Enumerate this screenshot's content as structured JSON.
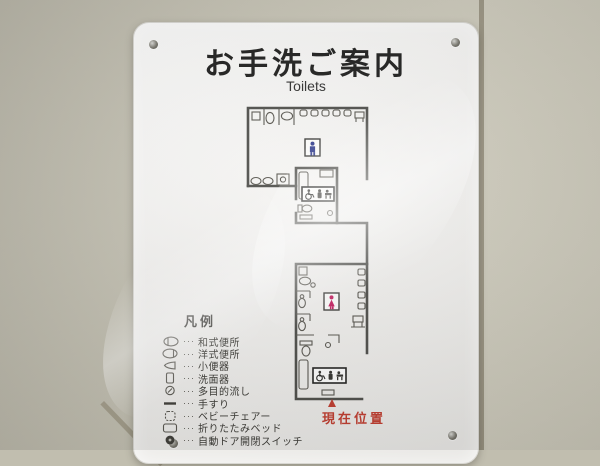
{
  "panel": {
    "title": "お手洗ご案内",
    "subtitle": "Toilets"
  },
  "floorplan": {
    "current_location_label": "現在位置",
    "mens_icon": "male-figure",
    "womens_icon": "female-figure",
    "accessible_icons": [
      "wheelchair",
      "baby-chair",
      "baby-changing"
    ]
  },
  "legend": {
    "heading": "凡例",
    "leader": "···",
    "items": [
      {
        "icon": "squat-toilet",
        "label": "和式便所"
      },
      {
        "icon": "western-toilet",
        "label": "洋式便所"
      },
      {
        "icon": "urinal",
        "label": "小便器"
      },
      {
        "icon": "washbasin",
        "label": "洗面器"
      },
      {
        "icon": "multipurpose-sink",
        "label": "多目的流し"
      },
      {
        "icon": "handrail",
        "label": "手すり"
      },
      {
        "icon": "baby-chair",
        "label": "ベビーチェアー"
      },
      {
        "icon": "folding-bed",
        "label": "折りたたみベッド"
      },
      {
        "icon": "auto-door-switch",
        "label": "自動ドア開閉スイッチ"
      }
    ]
  },
  "colors": {
    "male_icon": "#2e3a8c",
    "female_icon": "#c2185b",
    "current_location": "#c0392b",
    "panel_bg": "#f4f3f1",
    "wall_tile": "#c6c3b4",
    "tile_grout": "#8f8a77",
    "plan_line": "#4a4a46"
  }
}
